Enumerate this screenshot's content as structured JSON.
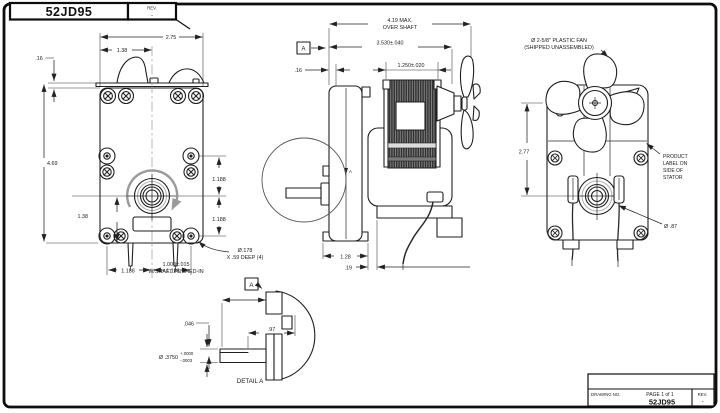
{
  "title_block_top": {
    "drawing_no": "52JD95",
    "rev_label": "REV.",
    "rev_value": "-"
  },
  "title_block_bottom": {
    "drawing_no_label": "DRAWING NO.",
    "page_label": "PAGE 1 of 1",
    "drawing_no": "52JD95",
    "rev_label": "REV.",
    "rev_value": "-"
  },
  "front_view": {
    "width_dim": "2.75",
    "half_width_dim": "1.38",
    "plate_gap_dim": ".16",
    "height_dim": "4.69",
    "shaft_to_base_dim": "1.38",
    "hole_spacing_dim": "1.188",
    "hole_note_line1": "Ø.178",
    "hole_note_line2": "X .59 DEEP (4)"
  },
  "side_view": {
    "overall_dim_line1": "4.19 MAX.",
    "overall_dim_line2": "OVER SHAFT",
    "length_dim": "3.530±.040",
    "stator_dim": "1.250±.020",
    "face_gap_dim": ".16",
    "foot_width_dim": "1.28",
    "foot_offset_dim": ".19",
    "datum_label": "A"
  },
  "rear_view": {
    "fan_note_line1": "Ø 2-5/8\" PLASTIC FAN",
    "fan_note_line2": "(SHIPPED UNASSEMBLED)",
    "shaft_center_dim": "2.77",
    "label_note_lines": [
      "PRODUCT",
      "LABEL ON",
      "SIDE OF",
      "STATOR"
    ],
    "boss_dia_dim": "Ø .87"
  },
  "detail_a": {
    "datum_label": "A",
    "length_dim_line1": "1.000±.015",
    "length_dim_line2": "W/SHAFT PUSHED-IN",
    "flat_dim": ".046",
    "hub_dim": ".97",
    "dia_dim": "Ø .3750",
    "dia_tol_plus": "+.0000",
    "dia_tol_minus": "-.0003",
    "caption": "DETAIL A"
  }
}
